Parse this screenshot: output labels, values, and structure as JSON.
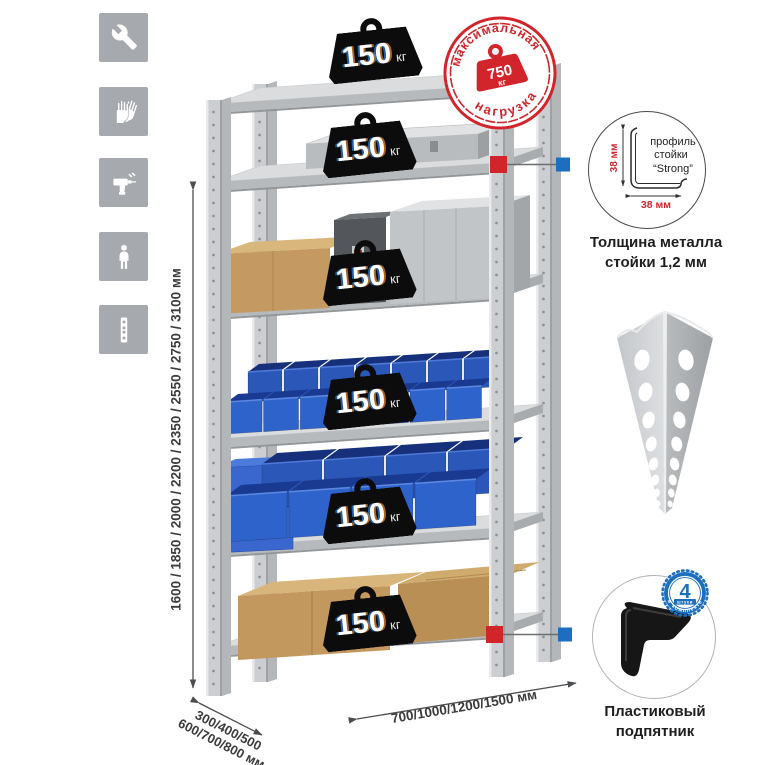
{
  "feature_icons": [
    {
      "name": "wrench"
    },
    {
      "name": "gloves"
    },
    {
      "name": "drill"
    },
    {
      "name": "person"
    },
    {
      "name": "perforated-post"
    }
  ],
  "dimensions": {
    "height": "1600 / 1850 / 2000 / 2200 / 2350 / 2550 / 2750 / 3100 мм",
    "depth_line1": "300/400/500",
    "depth_line2": "600/700/800 мм",
    "width": "700/1000/1200/1500 мм"
  },
  "shelf_loads": [
    {
      "value": "150",
      "unit": "кг"
    },
    {
      "value": "150",
      "unit": "кг"
    },
    {
      "value": "150",
      "unit": "кг"
    },
    {
      "value": "150",
      "unit": "кг"
    },
    {
      "value": "150",
      "unit": "кг"
    },
    {
      "value": "150",
      "unit": "кг"
    }
  ],
  "max_load_stamp": {
    "arc_top": "максимальная",
    "arc_bottom": "нагрузка",
    "value": "750",
    "unit": "кг"
  },
  "post_profile": {
    "label_line1": "профиль",
    "label_line2": "стойки",
    "label_line3": "“Strong”",
    "dim_vertical": "38 мм",
    "dim_horizontal": "38 мм",
    "caption_line1": "Толщина металла",
    "caption_line2": "стойки 1,2 мм"
  },
  "plastic_foot": {
    "caption_line1": "Пластиковый",
    "caption_line2": "подпятник",
    "badge_value": "4",
    "badge_small": "штуки",
    "badge_arc": "в комплекте"
  },
  "colors": {
    "accent_red": "#d2252b",
    "accent_blue": "#1c6fbe",
    "bin_blue": "#2f63cc",
    "metal_gray": "#ccced1"
  }
}
